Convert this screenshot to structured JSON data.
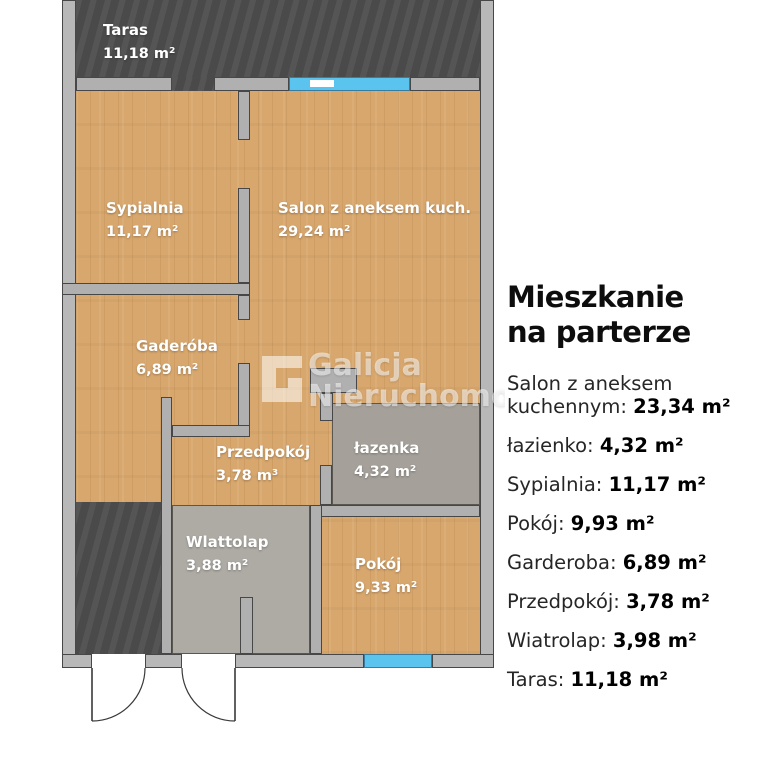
{
  "plan": {
    "rooms": [
      {
        "id": "taras",
        "name": "Taras",
        "area": "11,18 m²"
      },
      {
        "id": "sypialnia",
        "name": "Sypialnia",
        "area": "11,17 m²"
      },
      {
        "id": "salon",
        "name": "Salon z aneksem kuch.",
        "area": "29,24 m²"
      },
      {
        "id": "garderoba",
        "name": "Gaderóba",
        "area": "6,89 m²"
      },
      {
        "id": "przedpokoj",
        "name": "Przedpokój",
        "area": "3,78 m³"
      },
      {
        "id": "lazienka",
        "name": "łazenka",
        "area": "4,32 m²"
      },
      {
        "id": "wiatrolap",
        "name": "Wlattolap",
        "area": "3,88 m²"
      },
      {
        "id": "pokoj",
        "name": "Pokój",
        "area": "9,33 m²"
      }
    ],
    "colors": {
      "wood_floor": "#d8a76d",
      "terrace_dark": "#4e4e4e",
      "wall_gray": "#b0b0b0",
      "tile_gray": "#a5a09a",
      "window_blue": "#5ac4ef",
      "label_text": "#ffffff"
    }
  },
  "panel": {
    "title_line1": "Mieszkanie",
    "title_line2": "na parterze",
    "items": [
      {
        "label": "Salon z aneksem kuchennym:",
        "value": "23,34 m²"
      },
      {
        "label": "łazienko:",
        "value": "4,32 m²"
      },
      {
        "label": "Sypialnia:",
        "value": "11,17 m²"
      },
      {
        "label": "Pokój:",
        "value": "9,93 m²"
      },
      {
        "label": "Garderoba:",
        "value": "6,89 m²"
      },
      {
        "label": "Przedpokój:",
        "value": "3,78 m²"
      },
      {
        "label": "Wiatrolap:",
        "value": "3,98 m²"
      },
      {
        "label": "Taras:",
        "value": "11,18 m²"
      }
    ]
  },
  "watermark": {
    "line1": "Galicja",
    "line2": "Nieruchomoś",
    "logo": "galicja-g-logo"
  }
}
